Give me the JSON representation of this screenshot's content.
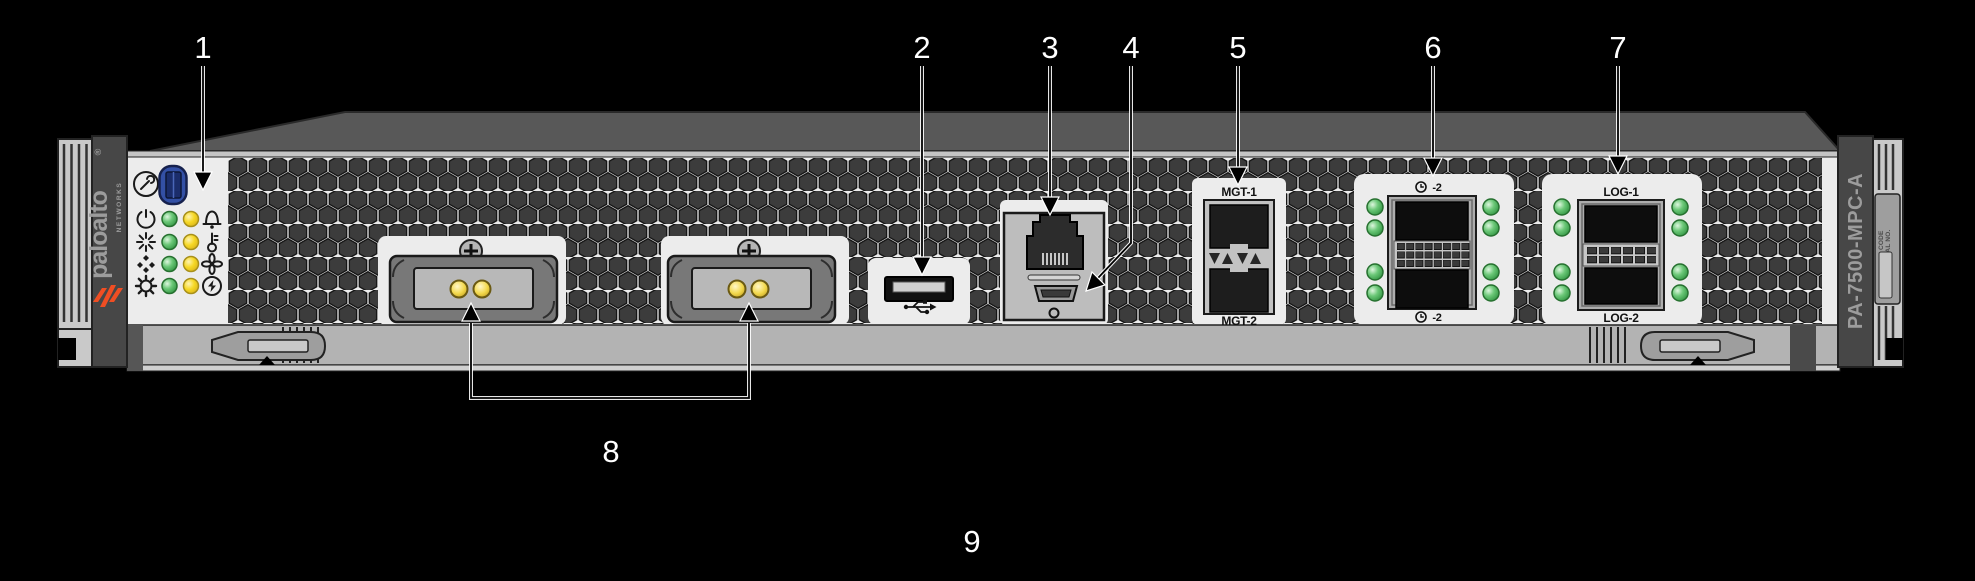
{
  "device": {
    "model": "PA-7500-MPC-A",
    "brand": "paloalto",
    "brand_sub": "NETWORKS",
    "brand_reg": "®",
    "plate_top": "CLEI CODE",
    "plate_bottom": "SERIAL NO."
  },
  "ports": {
    "mgt_top_label": "MGT-1",
    "mgt_bottom_label": "MGT-2",
    "clock_top_label": "-2",
    "clock_bottom_label": "-2",
    "log_top_label": "LOG-1",
    "log_bottom_label": "LOG-2"
  },
  "callouts": {
    "c1": "1",
    "c2": "2",
    "c3": "3",
    "c4": "4",
    "c5": "5",
    "c6": "6",
    "c7": "7",
    "c8": "8",
    "c9": "9"
  },
  "colors": {
    "background": "#000000",
    "faceplate": "#ececec",
    "vent_hex": "#3c3c3c",
    "brand_orange": "#f04e23",
    "led_green": "#3aa447",
    "led_yellow": "#f6d420",
    "led_amber": "#f0cf3a",
    "callout_text": "#ffffff"
  }
}
